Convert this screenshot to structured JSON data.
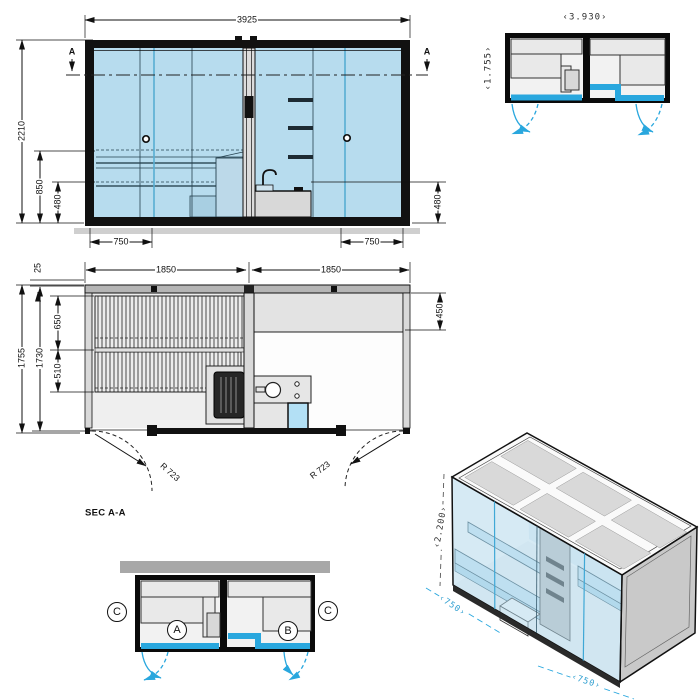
{
  "front_elevation": {
    "width": "3925",
    "height": "2210",
    "bench_height": "850",
    "sill_height_left": "480",
    "sill_height_right": "480",
    "door_width_left": "750",
    "door_width_right": "750",
    "section_marker_left": "A",
    "section_marker_right": "A"
  },
  "plan_view": {
    "module_width_left": "1850",
    "module_width_right": "1850",
    "wall_offset": "25",
    "depth_outer": "1755",
    "depth_inner": "1730",
    "bench_depth_upper": "650",
    "bench_depth_lower": "510",
    "bench_depth_right": "450",
    "door_radius_left": "R 723",
    "door_radius_right": "R 723",
    "section_label": "SEC A-A"
  },
  "mini_plan": {
    "width": "‹3.930›",
    "depth": "‹1.755›"
  },
  "section_plan": {
    "room_a_label": "A",
    "room_b_label": "B",
    "section_c_left": "C",
    "section_c_right": "C"
  },
  "isometric_view": {
    "height": "‹2.200›",
    "door_left_width": "‹750›",
    "door_right_width": "‹750›"
  },
  "colors": {
    "glass": "#b7dcee",
    "accent_cyan": "#29a7de",
    "wall_gray": "#a8a8a8"
  }
}
